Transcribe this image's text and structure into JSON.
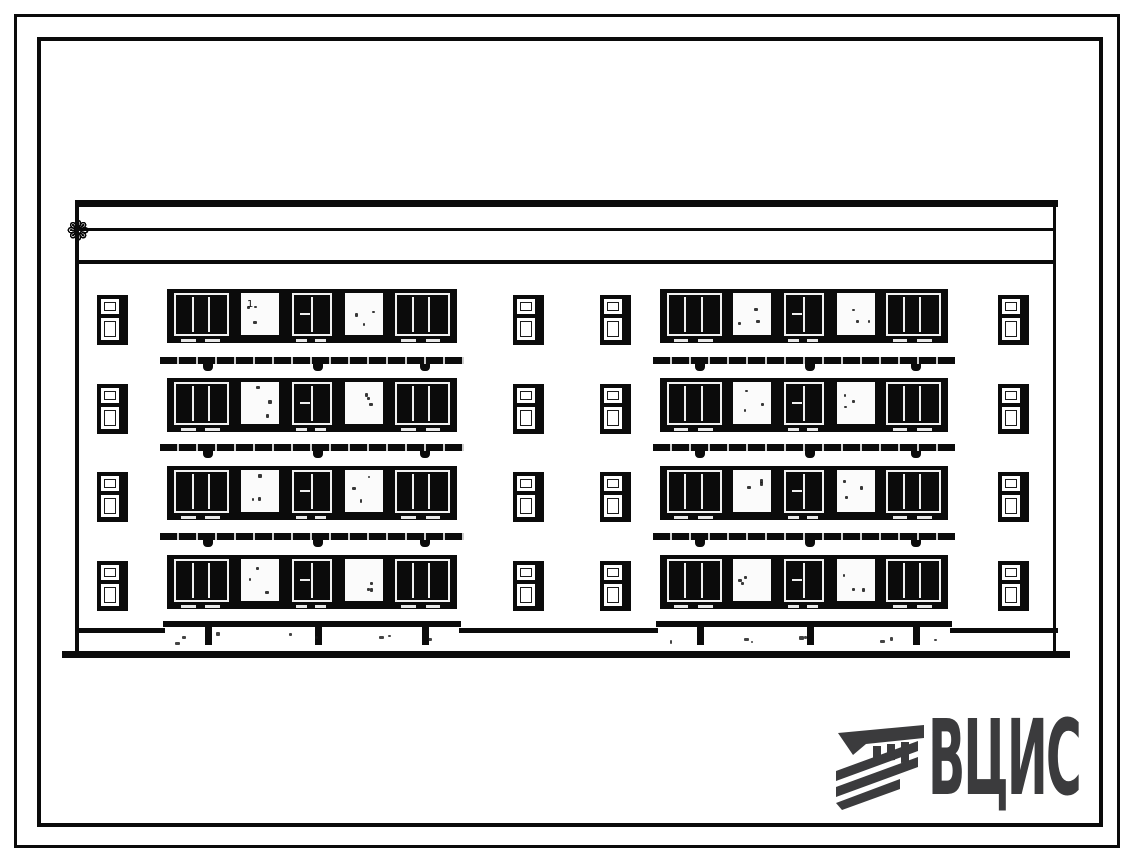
{
  "document": {
    "kind": "scanned architectural drawing sheet",
    "subject": "Four-storey residential building, street facade elevation",
    "background": "#ffffff",
    "ink_color": "#0b0b0b"
  },
  "drawing": {
    "floors": 4,
    "frieze": {
      "unit_count": 14,
      "rosette_glyph": "❁"
    },
    "window_groups": [
      {
        "side": "left",
        "large_windows": 3,
        "blank_panels": 2
      },
      {
        "side": "right",
        "large_windows": 3,
        "blank_panels": 2
      }
    ],
    "small_window_columns": 4,
    "balcony_rail_rows": 3,
    "brackets_per_rail": 3,
    "annotation": "1"
  },
  "logo": {
    "text": "ВЦИС",
    "color": "#3b3b3d",
    "icon": "hatched-column-capital"
  }
}
